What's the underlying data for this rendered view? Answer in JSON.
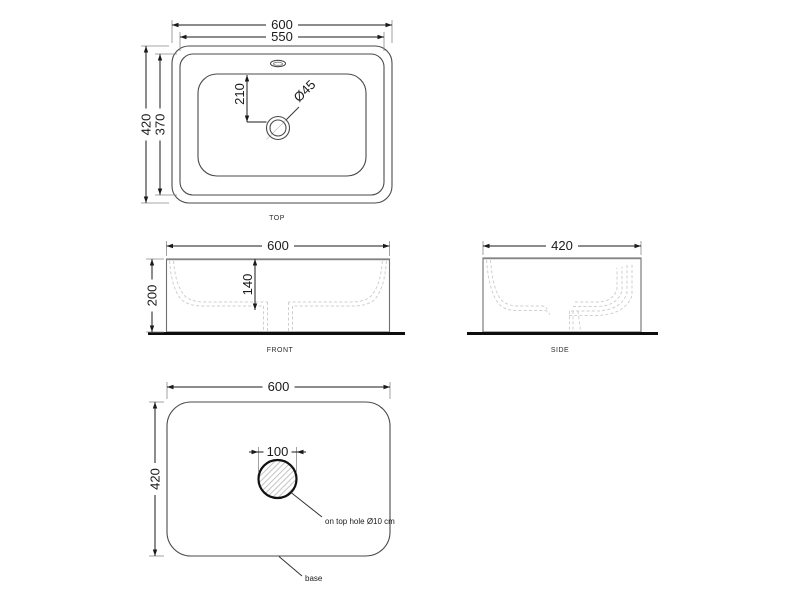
{
  "views": {
    "top": {
      "label": "TOP",
      "dim_outer_width": "600",
      "dim_inner_width": "550",
      "dim_outer_depth": "420",
      "dim_inner_depth": "370",
      "dim_drain_offset": "210",
      "dim_drain_diameter": "Ø45"
    },
    "front": {
      "label": "FRONT",
      "dim_width": "600",
      "dim_height": "200",
      "dim_basin_depth": "140"
    },
    "side": {
      "label": "SIDE",
      "dim_depth": "420"
    },
    "base": {
      "label": "base",
      "dim_width": "600",
      "dim_depth": "420",
      "dim_hole_width": "100",
      "hole_note": "on top hole Ø10 cm"
    }
  },
  "colors": {
    "background": "#ffffff",
    "geometry_line": "#4a4a4a",
    "dimension_line": "#1a1a1a",
    "hidden_dash_line": "#cfcfcf",
    "ground_line": "#0d0d0d",
    "hatch_line": "#c4c4c4"
  }
}
